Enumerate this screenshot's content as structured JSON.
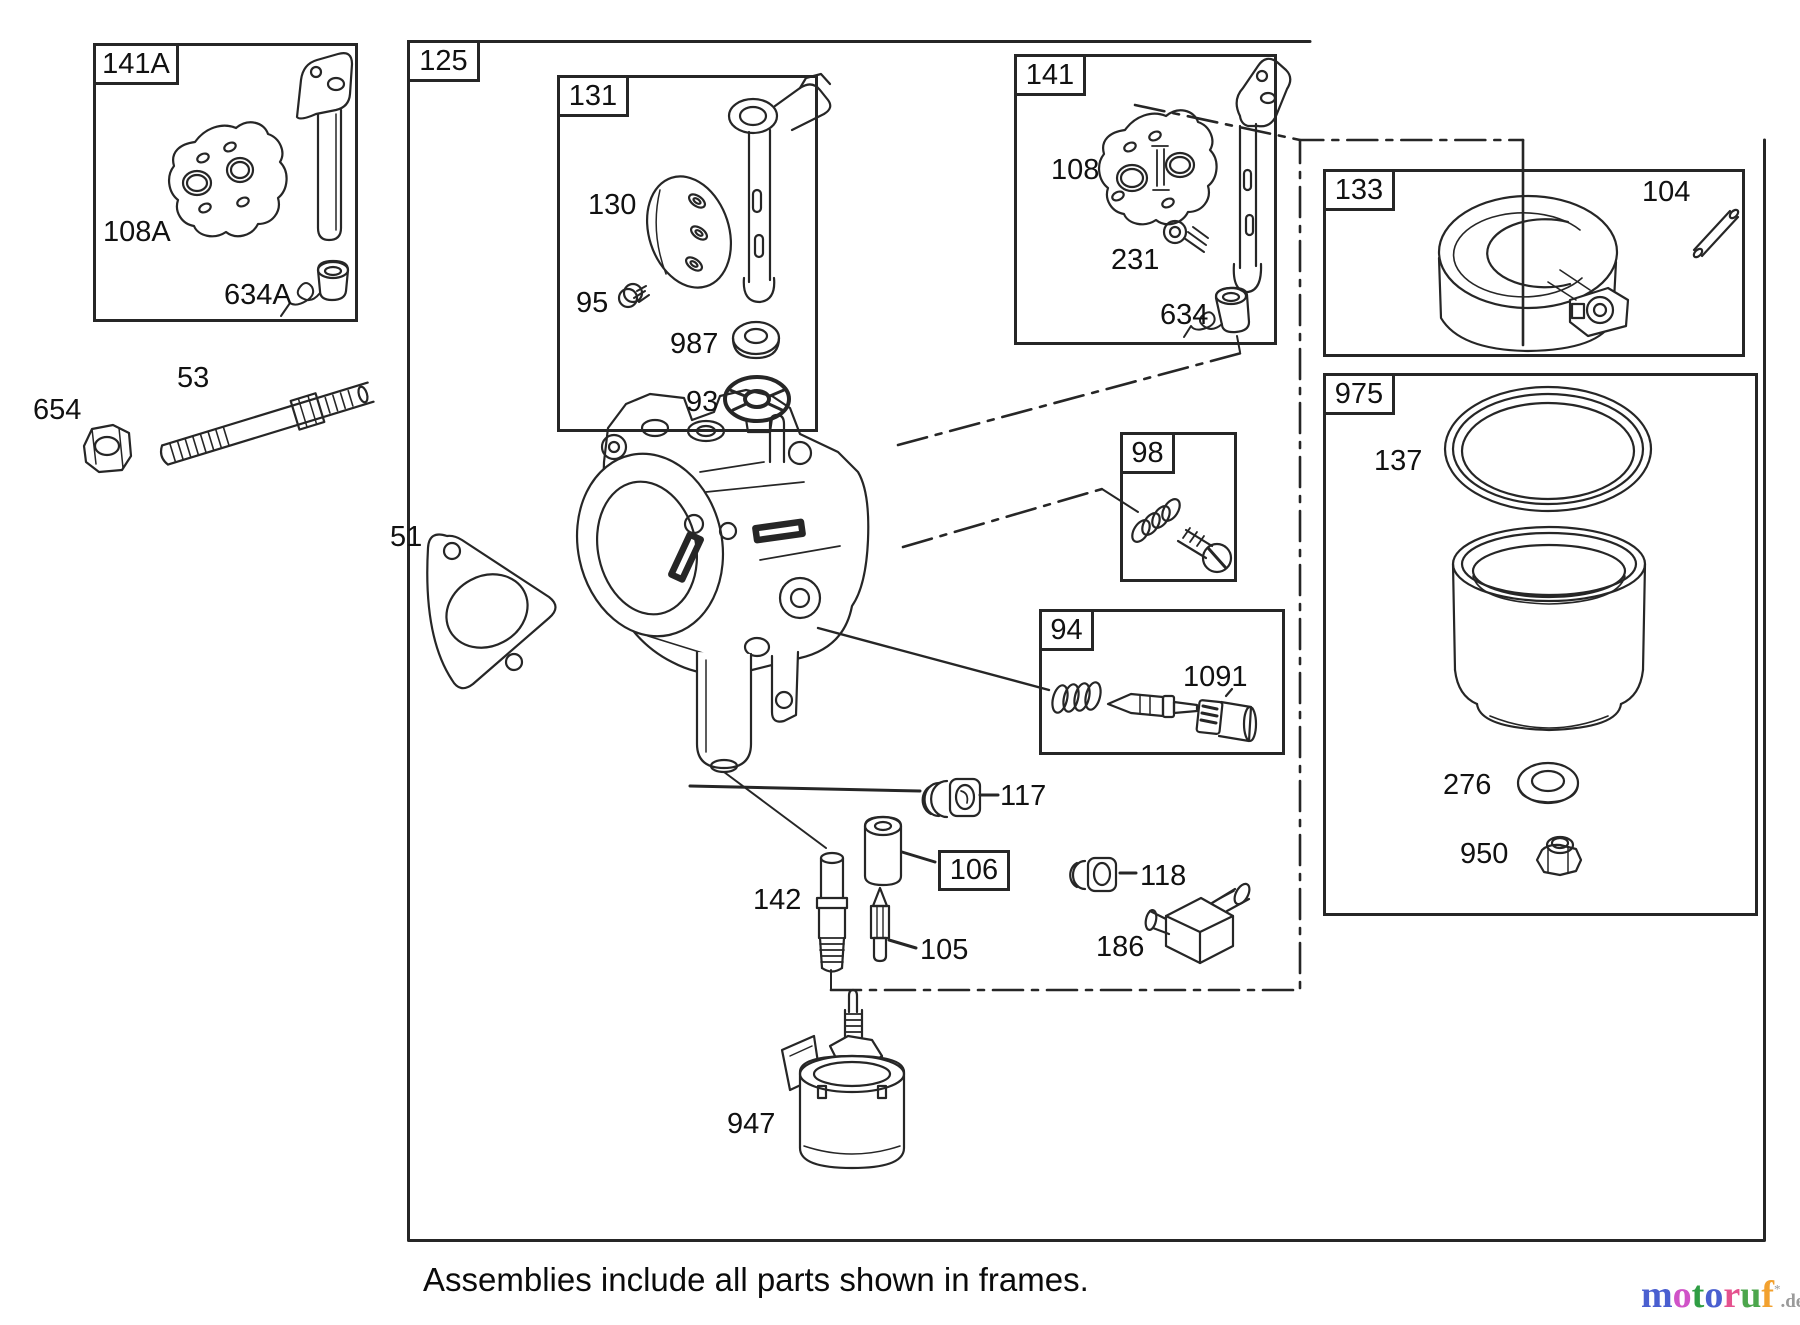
{
  "canvas": {
    "width": 1800,
    "height": 1325,
    "background": "#ffffff",
    "line_color": "#262626"
  },
  "frames": [
    {
      "label": "141A",
      "x": 93,
      "y": 43,
      "w": 265,
      "h": 279,
      "label_w": 86
    },
    {
      "label": "131",
      "x": 557,
      "y": 75,
      "w": 261,
      "h": 357,
      "label_w": 72
    },
    {
      "label": "141",
      "x": 1014,
      "y": 54,
      "w": 263,
      "h": 291,
      "label_w": 72
    },
    {
      "label": "98",
      "x": 1120,
      "y": 432,
      "w": 117,
      "h": 150,
      "label_w": 55
    },
    {
      "label": "94",
      "x": 1039,
      "y": 609,
      "w": 246,
      "h": 146,
      "label_w": 55
    },
    {
      "label": "133",
      "x": 1323,
      "y": 169,
      "w": 422,
      "h": 188,
      "label_w": 72
    },
    {
      "label": "975",
      "x": 1323,
      "y": 373,
      "w": 435,
      "h": 543,
      "label_w": 72
    }
  ],
  "boxed_labels": [
    {
      "text": "125",
      "x": 407,
      "y": 40,
      "w": 73,
      "h": 42
    },
    {
      "text": "106",
      "x": 938,
      "y": 850,
      "w": 72,
      "h": 41
    }
  ],
  "part_labels": [
    {
      "text": "108A",
      "x": 103,
      "y": 218
    },
    {
      "text": "634A",
      "x": 224,
      "y": 281
    },
    {
      "text": "654",
      "x": 33,
      "y": 396
    },
    {
      "text": "53",
      "x": 177,
      "y": 364
    },
    {
      "text": "51",
      "x": 390,
      "y": 523
    },
    {
      "text": "130",
      "x": 588,
      "y": 191
    },
    {
      "text": "95",
      "x": 576,
      "y": 289
    },
    {
      "text": "987",
      "x": 670,
      "y": 330
    },
    {
      "text": "93",
      "x": 686,
      "y": 388
    },
    {
      "text": "108",
      "x": 1051,
      "y": 156
    },
    {
      "text": "231",
      "x": 1111,
      "y": 246
    },
    {
      "text": "634",
      "x": 1160,
      "y": 301
    },
    {
      "text": "104",
      "x": 1642,
      "y": 178
    },
    {
      "text": "137",
      "x": 1374,
      "y": 447
    },
    {
      "text": "276",
      "x": 1443,
      "y": 771
    },
    {
      "text": "950",
      "x": 1460,
      "y": 840
    },
    {
      "text": "1091",
      "x": 1183,
      "y": 663
    },
    {
      "text": "117",
      "x": 1000,
      "y": 782
    },
    {
      "text": "118",
      "x": 1140,
      "y": 862
    },
    {
      "text": "105",
      "x": 920,
      "y": 936
    },
    {
      "text": "142",
      "x": 753,
      "y": 886
    },
    {
      "text": "186",
      "x": 1096,
      "y": 933
    },
    {
      "text": "947",
      "x": 727,
      "y": 1110
    }
  ],
  "caption": "Assemblies include all parts shown in frames.",
  "logo": {
    "letters": [
      {
        "ch": "m",
        "color": "#4a5fd0"
      },
      {
        "ch": "o",
        "color": "#d053c8"
      },
      {
        "ch": "t",
        "color": "#2f9e44"
      },
      {
        "ch": "o",
        "color": "#4a5fd0"
      },
      {
        "ch": "r",
        "color": "#e5528f"
      },
      {
        "ch": "u",
        "color": "#4ca64c"
      },
      {
        "ch": "f",
        "color": "#f2a12f"
      }
    ],
    "mark": "*",
    "suffix": ".de",
    "suffix_color": "#9a9a9a"
  }
}
